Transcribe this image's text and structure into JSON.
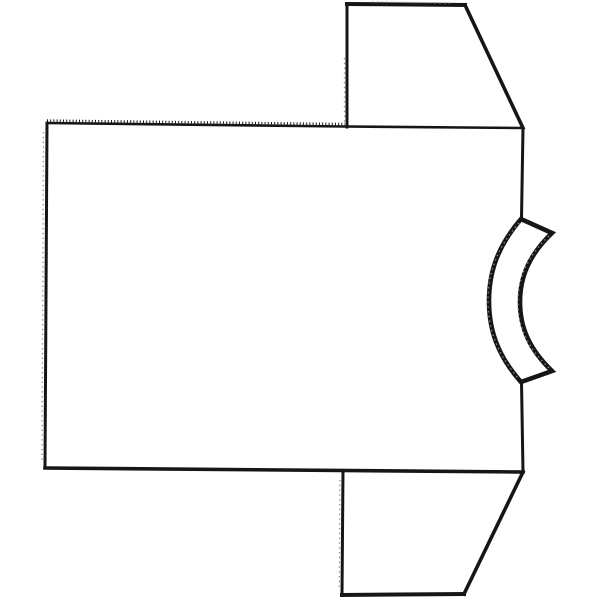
{
  "page": {
    "title": "T-shirt outline line drawing",
    "label": "Black-and-white outline drawing of a short-sleeve T-shirt lying on its side, neckline band facing right"
  },
  "colors": {
    "ink": "#161616",
    "background": "#ffffff",
    "texture": "#8f8f8f"
  },
  "drawing": {
    "viewbox": "0 0 600 600",
    "body": {
      "fill_points": "47,123 523,128 523,472 45,468",
      "top_edge": "M47,123 L345,126.5 L523,128",
      "top_serration": "M47,120.5 L345,124",
      "left_edge": "M47,123 L45,468",
      "left_texture": "M43.5,132 L42,460",
      "bottom_edge": "M45,468 L523,472",
      "right_edge_upper": "M523,128 L521.5,218",
      "right_edge_lower": "M521.5,382 L523,472"
    },
    "sleeve_top": {
      "fill_points": "347,4 465,5 523,128 347,127",
      "left_edge": "M347,4 L347,127",
      "left_texture": "M344.5,58 L344.5,124",
      "top_edge": "M347,4 L465,5",
      "top_texture": "M372,2 L450,3",
      "slant_edge": "M465,5 L523,128"
    },
    "sleeve_bottom": {
      "fill_points": "343,471 523,472 464,594 342,595",
      "left_edge": "M343,471 L342,595",
      "left_texture": "M339.8,480 L339.3,590",
      "bottom_edge": "M342,595 L464,594",
      "slant_edge": "M523,472 L464,594"
    },
    "collar": {
      "band_path": "M521,219 C497,247 489,273 489,301 C489,329 497,355 521,382 L552,371 C529,349 520,327 520,302 C520,277 529,255 552,233 Z",
      "outer_texture": "M519,223 C496,249 488,274 488,301 C488,328 496,352 518,378",
      "inner_texture": "M549,368 C527,347 518,326 518,302 C518,278 527,257 549,236"
    }
  }
}
